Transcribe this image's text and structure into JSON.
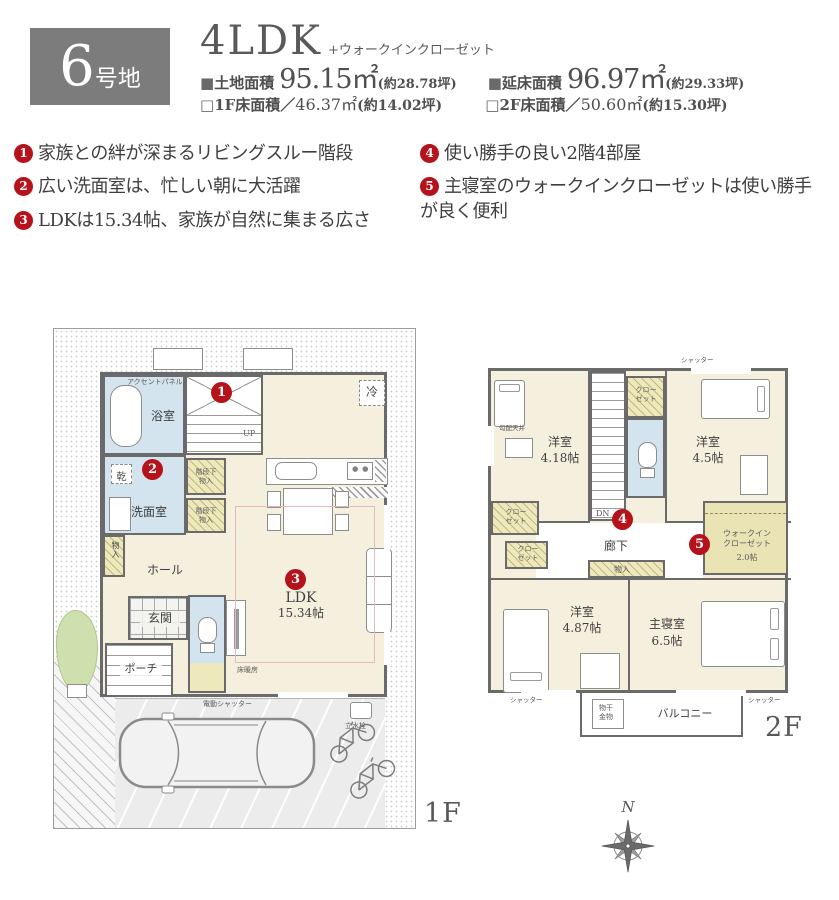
{
  "colors": {
    "accent_red": "#b5121b",
    "lot_box_gray": "#7c7c7c",
    "wall_gray": "#6a6a6a",
    "room_cream": "#f5efdd",
    "wet_area_blue": "#d3e4ee",
    "closet_yellow": "#eee8bd",
    "lawn_green": "#cde0ad",
    "floor_heating_pink": "#e4b9b9"
  },
  "header": {
    "lot_number": "6",
    "lot_suffix": "号地",
    "layout": "4LDK",
    "layout_note": "+ウォークインクローゼット",
    "areas": [
      {
        "marker": "■",
        "label": "土地面積",
        "value": "95.15㎡",
        "note": "(約28.78坪)"
      },
      {
        "marker": "■",
        "label": "延床面積",
        "value": "96.97㎡",
        "note": "(約29.33坪)"
      },
      {
        "marker": "□",
        "label": "1F床面積／",
        "value": "46.37㎡",
        "note": "(約14.02坪)"
      },
      {
        "marker": "□",
        "label": "2F床面積／",
        "value": "50.60㎡",
        "note": "(約15.30坪)"
      }
    ]
  },
  "features": [
    {
      "num": "1",
      "text": "家族との絆が深まるリビングスルー階段"
    },
    {
      "num": "2",
      "text": "広い洗面室は、忙しい朝に大活躍"
    },
    {
      "num": "3",
      "text": "LDKは15.34帖、家族が自然に集まる広さ"
    },
    {
      "num": "4",
      "text": "使い勝手の良い2階4部屋"
    },
    {
      "num": "5",
      "text": "主寝室のウォークインクローゼットは使い勝手が良く便利"
    }
  ],
  "markers": [
    "1",
    "2",
    "3",
    "4",
    "5"
  ],
  "floor1": {
    "label": "1F",
    "rooms": {
      "accent_panel": "アクセントパネル",
      "bath": "浴室",
      "up": "UP",
      "fridge": "冷",
      "dryer": "乾",
      "washroom": "洗面室",
      "stair_storage_upper": "階段下\n物入",
      "stair_storage_lower": "階段下\n物入",
      "storage": "物入",
      "hall": "ホール",
      "genkan": "玄関",
      "porch": "ポーチ",
      "ldk_name": "LDK",
      "ldk_size": "15.34帖",
      "floor_heating": "床暖房",
      "shutter": "電動シャッター",
      "standpipe": "立水栓"
    }
  },
  "floor2": {
    "label": "2F",
    "rooms": {
      "shutter_top": "シャッター",
      "western1_name": "洋室",
      "western1_size": "4.18帖",
      "sloped_ceiling": "勾配天井",
      "closet_top": "クロー\nゼット",
      "dn": "DN",
      "western2_name": "洋室",
      "western2_size": "4.5帖",
      "closet_left1": "クロー\nゼット",
      "closet_left2": "クロー\nゼット",
      "corridor": "廊下",
      "storage": "物入",
      "wic_name": "ウォークイン\nクローゼット",
      "wic_size": "2.0帖",
      "western3_name": "洋室",
      "western3_size": "4.87帖",
      "master_name": "主寝室",
      "master_size": "6.5帖",
      "balcony": "バルコニー",
      "laundry_hardware": "物干\n金物",
      "shutter_bottom_left": "シャッター",
      "shutter_bottom_right": "シャッター"
    }
  },
  "compass": {
    "north_label": "N"
  }
}
